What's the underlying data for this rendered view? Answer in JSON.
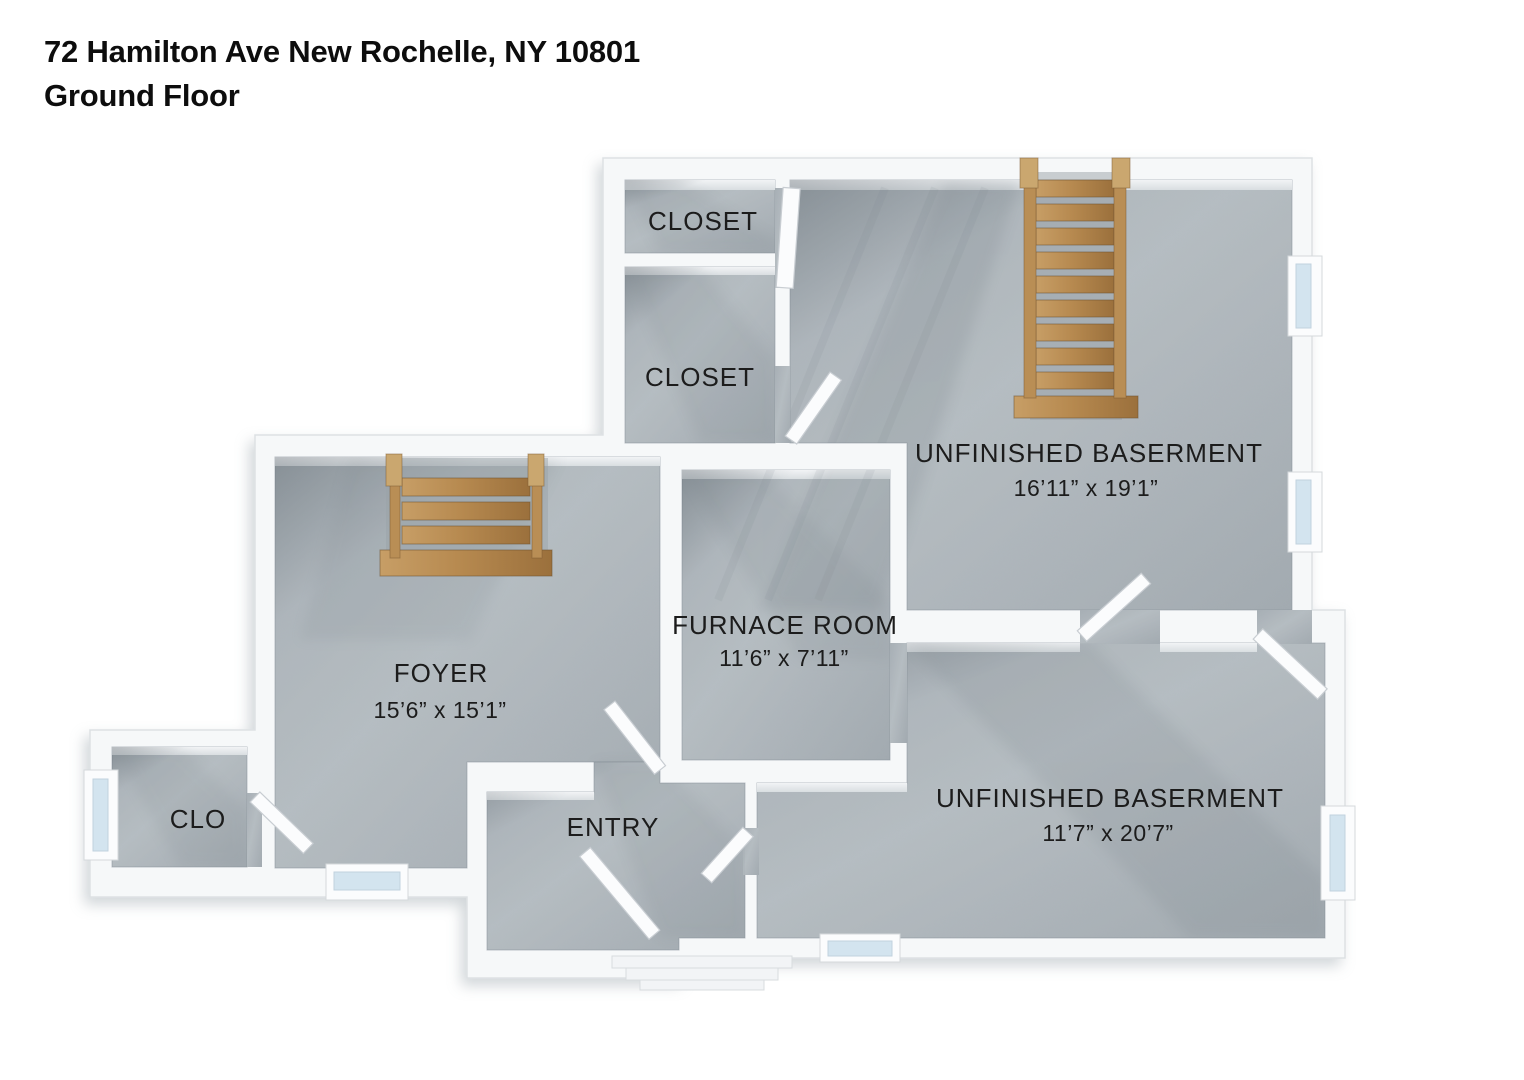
{
  "title": {
    "address": "72 Hamilton Ave New Rochelle, NY 10801",
    "floor": "Ground Floor"
  },
  "rooms": [
    {
      "id": "closet-top",
      "name": "CLOSET",
      "dims": ""
    },
    {
      "id": "closet-mid",
      "name": "CLOSET",
      "dims": ""
    },
    {
      "id": "unfinished-basement-upper",
      "name": "UNFINISHED BASERMENT",
      "dims": "16’11” x 19’1”"
    },
    {
      "id": "foyer",
      "name": "FOYER",
      "dims": "15’6” x 15’1”"
    },
    {
      "id": "furnace-room",
      "name": "FURNACE ROOM",
      "dims": "11’6” x 7’11”"
    },
    {
      "id": "clo",
      "name": "CLO",
      "dims": ""
    },
    {
      "id": "entry",
      "name": "ENTRY",
      "dims": ""
    },
    {
      "id": "unfinished-basement-lower",
      "name": "UNFINISHED BASERMENT",
      "dims": "11’7” x 20’7”"
    }
  ],
  "colors": {
    "background": "#ffffff",
    "wall": "#f6f8f9",
    "floor": "#b0b7bc",
    "wood": "#b5854f",
    "window_glass": "#d3e4ef",
    "text": "#1c1c1c"
  }
}
